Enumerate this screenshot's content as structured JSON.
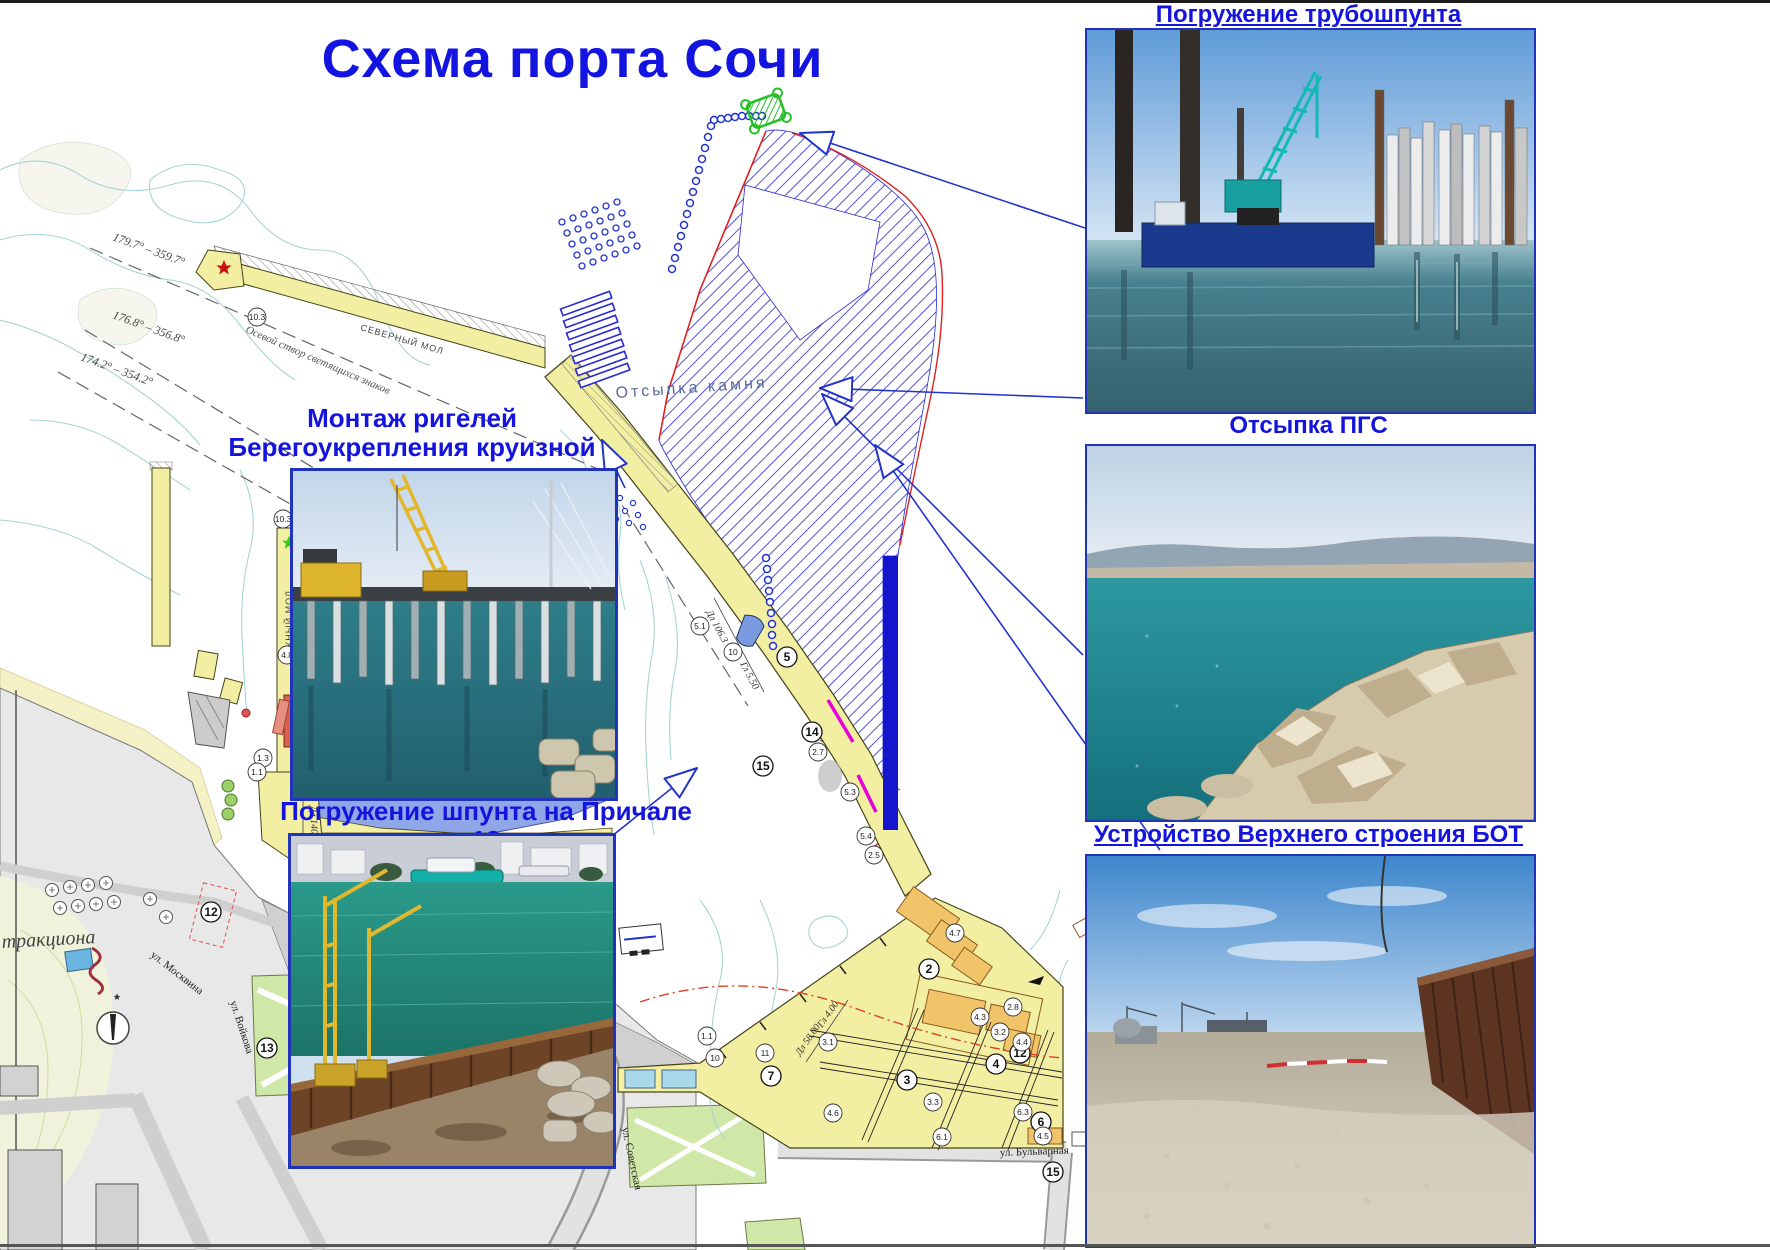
{
  "page": {
    "title": "Схема порта Сочи"
  },
  "right_panel": {
    "photos": [
      {
        "caption": "Погружение трубошпунта"
      },
      {
        "caption": "Отсыпка ПГС"
      },
      {
        "caption": "Устройство Верхнего строения БОТ"
      }
    ]
  },
  "map": {
    "labels": {
      "montazh1": "Монтаж ригелей",
      "montazh2": "Берегоукрепления круизной гавани",
      "sheet_pile": "Погружение шпунта на Причале 13",
      "rock_fill": "Отсыпка камня",
      "north_mole": "СЕВЕРНЫЙ МОЛ",
      "south_mole": "ЮЖНЫЙ МОЛ",
      "axis_note": "Осевой створ светящихся знаков",
      "bearing1": "179.7° – 359.7°",
      "bearing2": "176.8° – 356.8°",
      "bearing3": "174.2° – 354.2°",
      "street_bulvarnaya": "ул. Бульварная",
      "street_sovetskaya": "ул. Советская",
      "street_moskvina": "ул. Москвина",
      "street_voikova": "ул. Войкова",
      "street_morskoy": "пер. Морской",
      "attraction": "тракциона",
      "dim_south_len": "Дл 140.0",
      "dim_south_depth": "Гл 7.50",
      "dim_mid_len": "Дл 106.3",
      "dim_mid_depth": "Гл 5.50",
      "dim_east_len": "Дл 58.00",
      "dim_east_depth": "Гл 4.00"
    },
    "markers": [
      {
        "n": "5",
        "x": 787,
        "y": 657,
        "big": true
      },
      {
        "n": "14",
        "x": 812,
        "y": 732,
        "big": true
      },
      {
        "n": "15",
        "x": 763,
        "y": 766,
        "big": true
      },
      {
        "n": "7",
        "x": 771,
        "y": 1076,
        "big": true
      },
      {
        "n": "3",
        "x": 907,
        "y": 1080,
        "big": true
      },
      {
        "n": "2",
        "x": 929,
        "y": 969,
        "big": true
      },
      {
        "n": "4",
        "x": 996,
        "y": 1064,
        "big": true
      },
      {
        "n": "6",
        "x": 1041,
        "y": 1122,
        "big": true
      },
      {
        "n": "12",
        "x": 1020,
        "y": 1053,
        "big": true
      },
      {
        "n": "12",
        "x": 211,
        "y": 912,
        "big": true
      },
      {
        "n": "13",
        "x": 267,
        "y": 1048,
        "big": true
      },
      {
        "n": "15",
        "x": 1053,
        "y": 1172,
        "big": true
      },
      {
        "n": "10",
        "x": 733,
        "y": 652,
        "big": false
      },
      {
        "n": "2",
        "x": 303,
        "y": 852,
        "big": false
      },
      {
        "n": "11",
        "x": 765,
        "y": 1053,
        "big": false
      },
      {
        "n": "10",
        "x": 715,
        "y": 1058,
        "big": false
      },
      {
        "n": "10.3",
        "x": 257,
        "y": 317,
        "big": false
      },
      {
        "n": "10.3",
        "x": 283,
        "y": 519,
        "big": false
      },
      {
        "n": "4.8",
        "x": 287,
        "y": 655,
        "big": false
      },
      {
        "n": "5.1",
        "x": 700,
        "y": 626,
        "big": false
      },
      {
        "n": "2.7",
        "x": 818,
        "y": 752,
        "big": false
      },
      {
        "n": "5.3",
        "x": 850,
        "y": 792,
        "big": false
      },
      {
        "n": "5.4",
        "x": 866,
        "y": 836,
        "big": false
      },
      {
        "n": "2.5",
        "x": 874,
        "y": 855,
        "big": false
      },
      {
        "n": "1.3",
        "x": 263,
        "y": 758,
        "big": false
      },
      {
        "n": "1.1",
        "x": 257,
        "y": 772,
        "big": false
      },
      {
        "n": "2.8",
        "x": 1013,
        "y": 1007,
        "big": false
      },
      {
        "n": "4.7",
        "x": 955,
        "y": 933,
        "big": false
      },
      {
        "n": "3.1",
        "x": 828,
        "y": 1042,
        "big": false
      },
      {
        "n": "3.3",
        "x": 933,
        "y": 1102,
        "big": false
      },
      {
        "n": "6.1",
        "x": 942,
        "y": 1137,
        "big": false
      },
      {
        "n": "4.6",
        "x": 833,
        "y": 1113,
        "big": false
      },
      {
        "n": "6.3",
        "x": 1023,
        "y": 1112,
        "big": false
      },
      {
        "n": "4.3",
        "x": 980,
        "y": 1017,
        "big": false
      },
      {
        "n": "3.2",
        "x": 1000,
        "y": 1032,
        "big": false
      },
      {
        "n": "4.4",
        "x": 1022,
        "y": 1042,
        "big": false
      },
      {
        "n": "4.5",
        "x": 1043,
        "y": 1136,
        "big": false
      },
      {
        "n": "1.1",
        "x": 707,
        "y": 1036,
        "big": false
      }
    ]
  }
}
